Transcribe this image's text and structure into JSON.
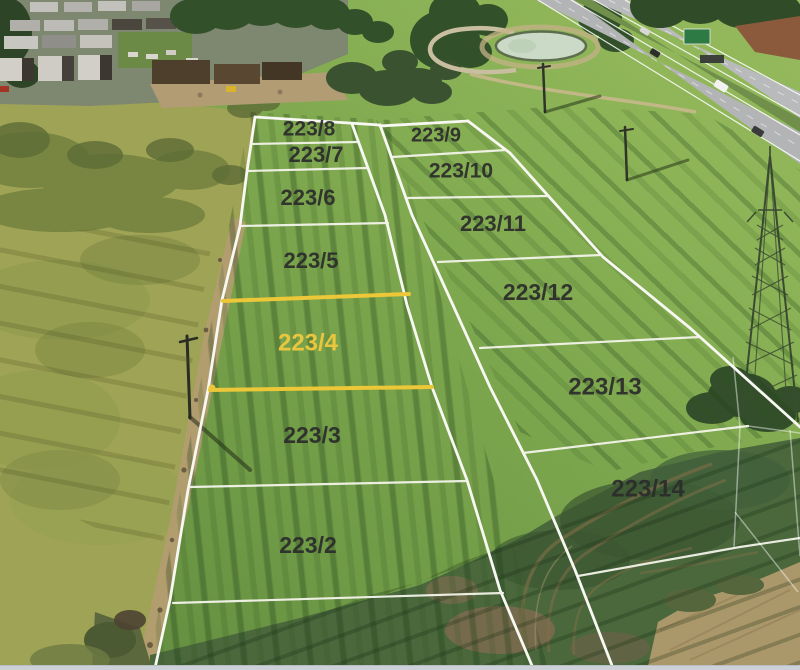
{
  "scene": {
    "description": "Aerial drone photo of subdivided land parcels beside a motorway; parcel 223/4 highlighted",
    "footer_bar_color": "#ccd1d7"
  },
  "styles": {
    "boundary_color": "#f8f8f3",
    "divider_color": "#f3f3ea",
    "faint_line_color": "#ffffff",
    "highlight_color": "#ecc738",
    "label_color": "#2c2c2c",
    "highlight_label_color": "#e9c63e"
  },
  "parcels": [
    {
      "label": "223/8",
      "x": 309,
      "y": 130,
      "size": 21,
      "highlighted": false
    },
    {
      "label": "223/7",
      "x": 316,
      "y": 156,
      "size": 22,
      "highlighted": false
    },
    {
      "label": "223/6",
      "x": 308,
      "y": 199,
      "size": 22,
      "highlighted": false
    },
    {
      "label": "223/5",
      "x": 311,
      "y": 262,
      "size": 22,
      "highlighted": false
    },
    {
      "label": "223/4",
      "x": 308,
      "y": 344,
      "size": 24,
      "highlighted": true
    },
    {
      "label": "223/3",
      "x": 312,
      "y": 437,
      "size": 23,
      "highlighted": false
    },
    {
      "label": "223/2",
      "x": 308,
      "y": 547,
      "size": 23,
      "highlighted": false
    },
    {
      "label": "223/9",
      "x": 436,
      "y": 136,
      "size": 20,
      "highlighted": false
    },
    {
      "label": "223/10",
      "x": 461,
      "y": 172,
      "size": 21,
      "highlighted": false
    },
    {
      "label": "223/11",
      "x": 493,
      "y": 225,
      "size": 22,
      "highlighted": false
    },
    {
      "label": "223/12",
      "x": 538,
      "y": 294,
      "size": 23,
      "highlighted": false
    },
    {
      "label": "223/13",
      "x": 605,
      "y": 388,
      "size": 24,
      "highlighted": false
    },
    {
      "label": "223/14",
      "x": 648,
      "y": 490,
      "size": 24,
      "highlighted": false
    }
  ],
  "boundaries": {
    "main": [
      {
        "name": "left-edge",
        "points": [
          [
            255,
            117
          ],
          [
            247,
            171
          ],
          [
            240,
            226
          ],
          [
            222,
            300
          ],
          [
            208,
            390
          ],
          [
            188,
            490
          ],
          [
            170,
            600
          ],
          [
            155,
            668
          ]
        ]
      },
      {
        "name": "left-column-top",
        "points": [
          [
            255,
            117
          ],
          [
            380,
            125
          ]
        ]
      },
      {
        "name": "strip-left",
        "points": [
          [
            352,
            124
          ],
          [
            385,
            215
          ],
          [
            407,
            305
          ],
          [
            432,
            387
          ],
          [
            467,
            480
          ],
          [
            500,
            590
          ],
          [
            533,
            668
          ]
        ]
      },
      {
        "name": "strip-right",
        "points": [
          [
            380,
            125
          ],
          [
            412,
            215
          ],
          [
            452,
            303
          ],
          [
            490,
            387
          ],
          [
            537,
            480
          ],
          [
            575,
            570
          ],
          [
            613,
            668
          ]
        ]
      },
      {
        "name": "right-column-top",
        "points": [
          [
            380,
            126
          ],
          [
            468,
            121
          ]
        ]
      },
      {
        "name": "right-edge",
        "points": [
          [
            468,
            121
          ],
          [
            510,
            153
          ],
          [
            552,
            200
          ],
          [
            603,
            257
          ],
          [
            690,
            328
          ],
          [
            800,
            427
          ]
        ]
      }
    ],
    "dividers": [
      {
        "between": "223/8-223/7",
        "points": [
          [
            251,
            144
          ],
          [
            357,
            142
          ]
        ]
      },
      {
        "between": "223/7-223/6",
        "points": [
          [
            247,
            171
          ],
          [
            367,
            168
          ]
        ]
      },
      {
        "between": "223/6-223/5",
        "points": [
          [
            240,
            226
          ],
          [
            388,
            223
          ]
        ]
      },
      {
        "between": "223/3-223/2",
        "points": [
          [
            190,
            487
          ],
          [
            467,
            481
          ]
        ]
      },
      {
        "between": "223/2-lower",
        "points": [
          [
            173,
            603
          ],
          [
            503,
            593
          ]
        ]
      },
      {
        "between": "223/9-223/10",
        "points": [
          [
            392,
            157
          ],
          [
            506,
            150
          ]
        ]
      },
      {
        "between": "223/10-223/11",
        "points": [
          [
            408,
            198
          ],
          [
            549,
            196
          ]
        ]
      },
      {
        "between": "223/11-223/12",
        "points": [
          [
            438,
            262
          ],
          [
            601,
            255
          ]
        ]
      },
      {
        "between": "223/12-223/13",
        "points": [
          [
            480,
            348
          ],
          [
            700,
            337
          ]
        ]
      },
      {
        "between": "223/13-223/14",
        "points": [
          [
            523,
            453
          ],
          [
            748,
            426
          ]
        ]
      },
      {
        "between": "223/14-lower",
        "points": [
          [
            578,
            576
          ],
          [
            740,
            547
          ],
          [
            800,
            538
          ]
        ]
      }
    ],
    "faint": [
      {
        "points": [
          [
            733,
            357
          ],
          [
            740,
            427
          ],
          [
            734,
            547
          ]
        ]
      },
      {
        "points": [
          [
            748,
            426
          ],
          [
            800,
            433
          ]
        ]
      },
      {
        "points": [
          [
            790,
            430
          ],
          [
            800,
            556
          ]
        ]
      },
      {
        "points": [
          [
            735,
            512
          ],
          [
            798,
            592
          ]
        ]
      }
    ],
    "highlight": [
      {
        "name": "223/4-top",
        "points": [
          [
            223,
            301
          ],
          [
            409,
            294
          ]
        ]
      },
      {
        "name": "223/4-bottom",
        "points": [
          [
            210,
            390
          ],
          [
            432,
            387
          ]
        ]
      }
    ],
    "highlight_marker": {
      "x": 212,
      "y": 388,
      "r": 3.5
    }
  }
}
